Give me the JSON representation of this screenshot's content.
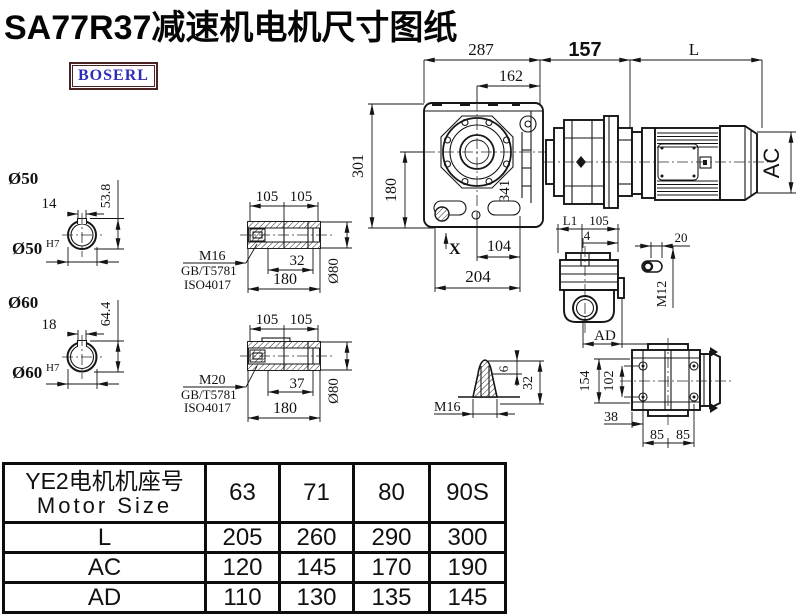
{
  "page": {
    "title": "SA77R37减速机电机尺寸图纸",
    "logo": "BOSERL"
  },
  "dims": {
    "top": {
      "d287": "287",
      "d162": "162",
      "d157": "157",
      "dL": "L"
    },
    "front": {
      "d301": "301",
      "d180": "180",
      "d341": "341",
      "dX": "X",
      "d104": "104",
      "d204": "204"
    },
    "motor": {
      "dAC": "AC"
    },
    "bore50": {
      "label": "Ø50",
      "key_w": "14",
      "key_h": "53.8",
      "bore": "Ø50",
      "tol": "H7"
    },
    "bore60": {
      "label": "Ø60",
      "key_w": "18",
      "key_h": "64.4",
      "bore": "Ø60",
      "tol": "H7"
    },
    "shaft1": {
      "l1": "105",
      "l2": "105",
      "screw": "M16",
      "std1": "GB/T5781",
      "std2": "ISO4017",
      "t": "32",
      "len": "180",
      "dia": "Ø80"
    },
    "shaft2": {
      "l1": "105",
      "l2": "105",
      "screw": "M20",
      "std1": "GB/T5781",
      "std2": "ISO4017",
      "t": "37",
      "len": "180",
      "dia": "Ø80"
    },
    "side": {
      "dL1": "L1",
      "d105": "105",
      "d4": "4",
      "dAD": "AD"
    },
    "key": {
      "d20": "20",
      "thread": "M12"
    },
    "plug": {
      "d6": "6",
      "d32": "32",
      "thread": "M16"
    },
    "back": {
      "d154": "154",
      "d102": "102",
      "d38": "38",
      "d85a": "85",
      "d85b": "85"
    }
  },
  "table": {
    "header_cn": "YE2电机机座号",
    "header_en": "Motor Size",
    "columns": [
      "63",
      "71",
      "80",
      "90S"
    ],
    "rows": [
      {
        "label": "L",
        "values": [
          "205",
          "260",
          "290",
          "300"
        ]
      },
      {
        "label": "AC",
        "values": [
          "120",
          "145",
          "170",
          "190"
        ]
      },
      {
        "label": "AD",
        "values": [
          "110",
          "130",
          "135",
          "145"
        ]
      }
    ]
  }
}
